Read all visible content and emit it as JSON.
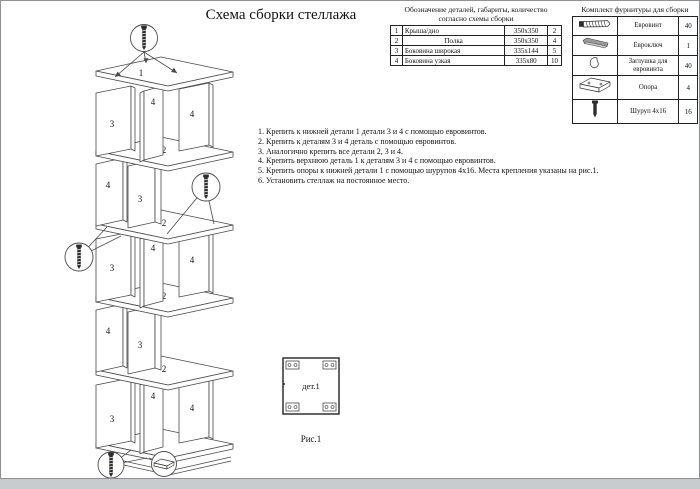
{
  "page": {
    "title": "Схема сборки стеллажа"
  },
  "parts_table": {
    "caption_line1": "Обозначение деталей, габариты, количество",
    "caption_line2": "согласно схемы сборки",
    "rows": [
      {
        "num": "1",
        "name": "Крыша/дно",
        "size": "350х350",
        "qty": "2"
      },
      {
        "num": "2",
        "name": "Полка",
        "size": "350х350",
        "qty": "4"
      },
      {
        "num": "3",
        "name": "Боковина широкая",
        "size": "335х144",
        "qty": "5"
      },
      {
        "num": "4",
        "name": "Боковина узкая",
        "size": "335х80",
        "qty": "10"
      }
    ]
  },
  "hardware_table": {
    "title": "Комплект фурнитуры для сборки",
    "rows": [
      {
        "icon": "euroscrew-icon",
        "name": "Евровинт",
        "qty": "40"
      },
      {
        "icon": "hexkey-icon",
        "name": "Евроключ",
        "qty": "1"
      },
      {
        "icon": "cap-icon",
        "name": "Заглушка для евровинта",
        "qty": "40"
      },
      {
        "icon": "support-icon",
        "name": "Опора",
        "qty": "4"
      },
      {
        "icon": "screw-icon",
        "name": "Шуруп 4х16",
        "qty": "16"
      }
    ]
  },
  "instructions": {
    "steps": [
      "1. Крепить к нижней детали 1 детали 3 и 4 с помощью евровинтов.",
      "2. Крепить к деталям 3 и 4 деталь с помощью евровинтов.",
      "3. Аналогично крепить все детали 2, 3 и 4.",
      "4. Крепить верхнюю деталь 1 к деталям 3 и 4 с помощью евровинтов.",
      "5. Крепить опоры к нижней детали 1 с помощью шурупов 4х16. Места крепления указаны на рис.1.",
      "6. Установить стеллаж на постоянное место."
    ]
  },
  "figure": {
    "part_label": "дет.1",
    "caption": "Рис.1"
  },
  "tower": {
    "labels": [
      "1",
      "3",
      "4",
      "4",
      "2",
      "4",
      "3",
      "2",
      "3",
      "4",
      "4",
      "2",
      "4",
      "3",
      "2",
      "3",
      "4",
      "4",
      "1"
    ]
  },
  "colors": {
    "line": "#4a4a4a",
    "text": "#111111",
    "page_bg": "#ffffff",
    "footer_strip": "#c9cccf"
  }
}
